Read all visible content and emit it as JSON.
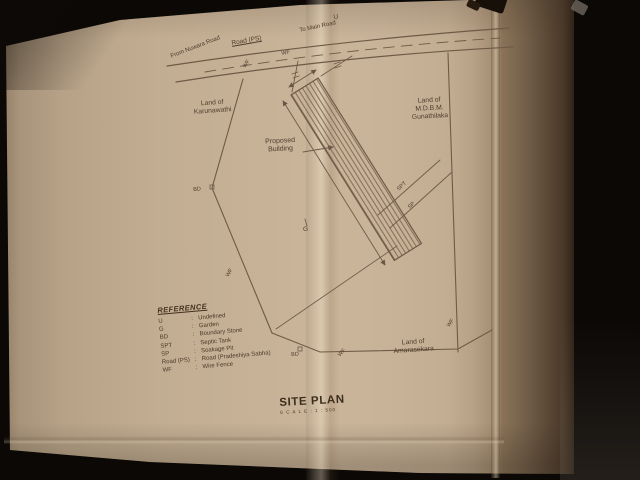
{
  "road": {
    "name": "Road (PS)",
    "from": "From Nuwara Road",
    "to": "To Main Road",
    "over_mark": "U"
  },
  "marks": {
    "wf": "WF",
    "bd": "BD",
    "g": "G",
    "spt": "SPT",
    "sp": "SP"
  },
  "lands": {
    "west": {
      "l1": "Land of",
      "l2": "Karunawathi"
    },
    "east": {
      "l1": "Land of",
      "l2": "M.D.B.M.",
      "l3": "Gunathilaka"
    },
    "south": {
      "l1": "Land of",
      "l2": "Amarasekara"
    }
  },
  "building": {
    "l1": "Proposed",
    "l2": "Building"
  },
  "legend": {
    "heading": "REFERENCE",
    "items": [
      {
        "abbr": "U",
        "sep": ":",
        "meaning": "Undefined"
      },
      {
        "abbr": "G",
        "sep": ":",
        "meaning": "Garden"
      },
      {
        "abbr": "BD",
        "sep": ":",
        "meaning": "Boundary Stone"
      },
      {
        "abbr": "SPT",
        "sep": ":",
        "meaning": "Septic Tank"
      },
      {
        "abbr": "SP",
        "sep": ":",
        "meaning": "Soakage Pit"
      },
      {
        "abbr": "Road (PS)",
        "sep": ":",
        "meaning": "Road (Pradeshiya Sabha)"
      },
      {
        "abbr": "WF",
        "sep": ":",
        "meaning": "Wire Fence"
      }
    ]
  },
  "title_block": {
    "title": "SITE PLAN",
    "scale": "S C A L E : 1 : 500"
  }
}
